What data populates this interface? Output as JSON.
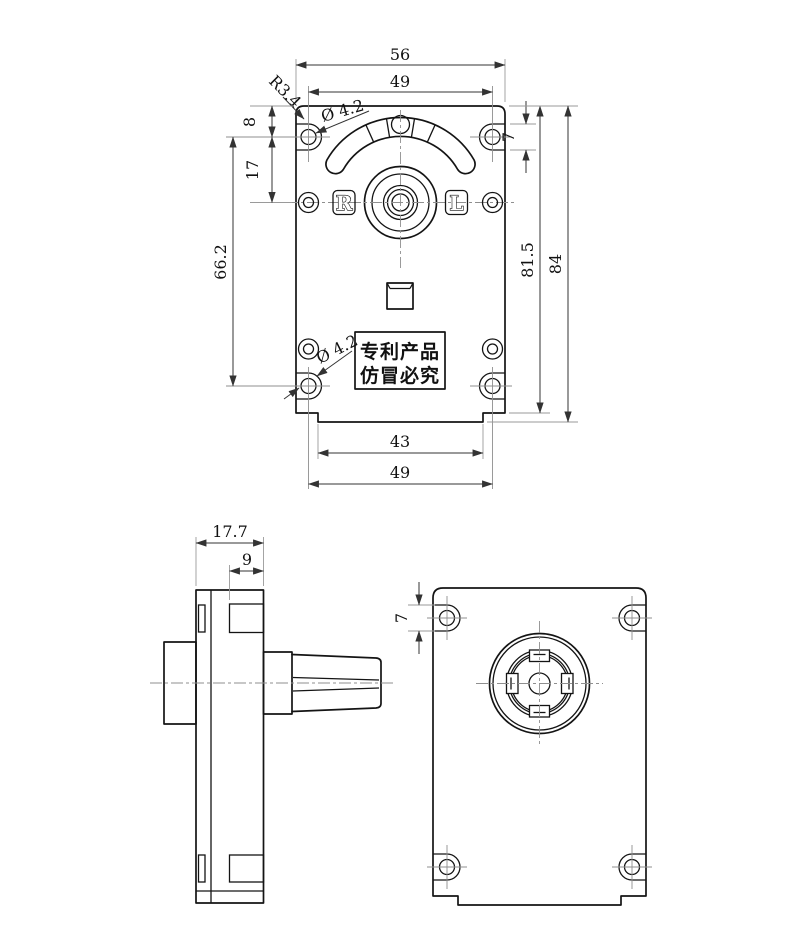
{
  "drawing": {
    "front": {
      "dim_width_top": "56",
      "dim_hole_span_top": "49",
      "radius_label": "R3.4",
      "dia_label_top": "Ø 4.2",
      "dim_edge_to_hole": "8",
      "dim_hole_pitch": "17",
      "dim_hole_span_vertical": "66.2",
      "dim_ear_height": "7",
      "dim_height_to_step": "81.5",
      "dim_height_total": "84",
      "dia_label_bottom": "Ø 4.2",
      "dim_tab_span": "43",
      "dim_hole_span_bottom": "49",
      "marker_right": "R",
      "marker_left": "L",
      "patent_line1": "专利产品",
      "patent_line2": "仿冒必究"
    },
    "side": {
      "dim_depth_total": "17.7",
      "dim_case_depth": "9"
    },
    "back": {
      "dim_ear_height": "7"
    },
    "colors": {
      "background": "#ffffff",
      "outline": "#141414",
      "dimension_line": "#333333",
      "extension_line": "#9a9a9a"
    }
  }
}
